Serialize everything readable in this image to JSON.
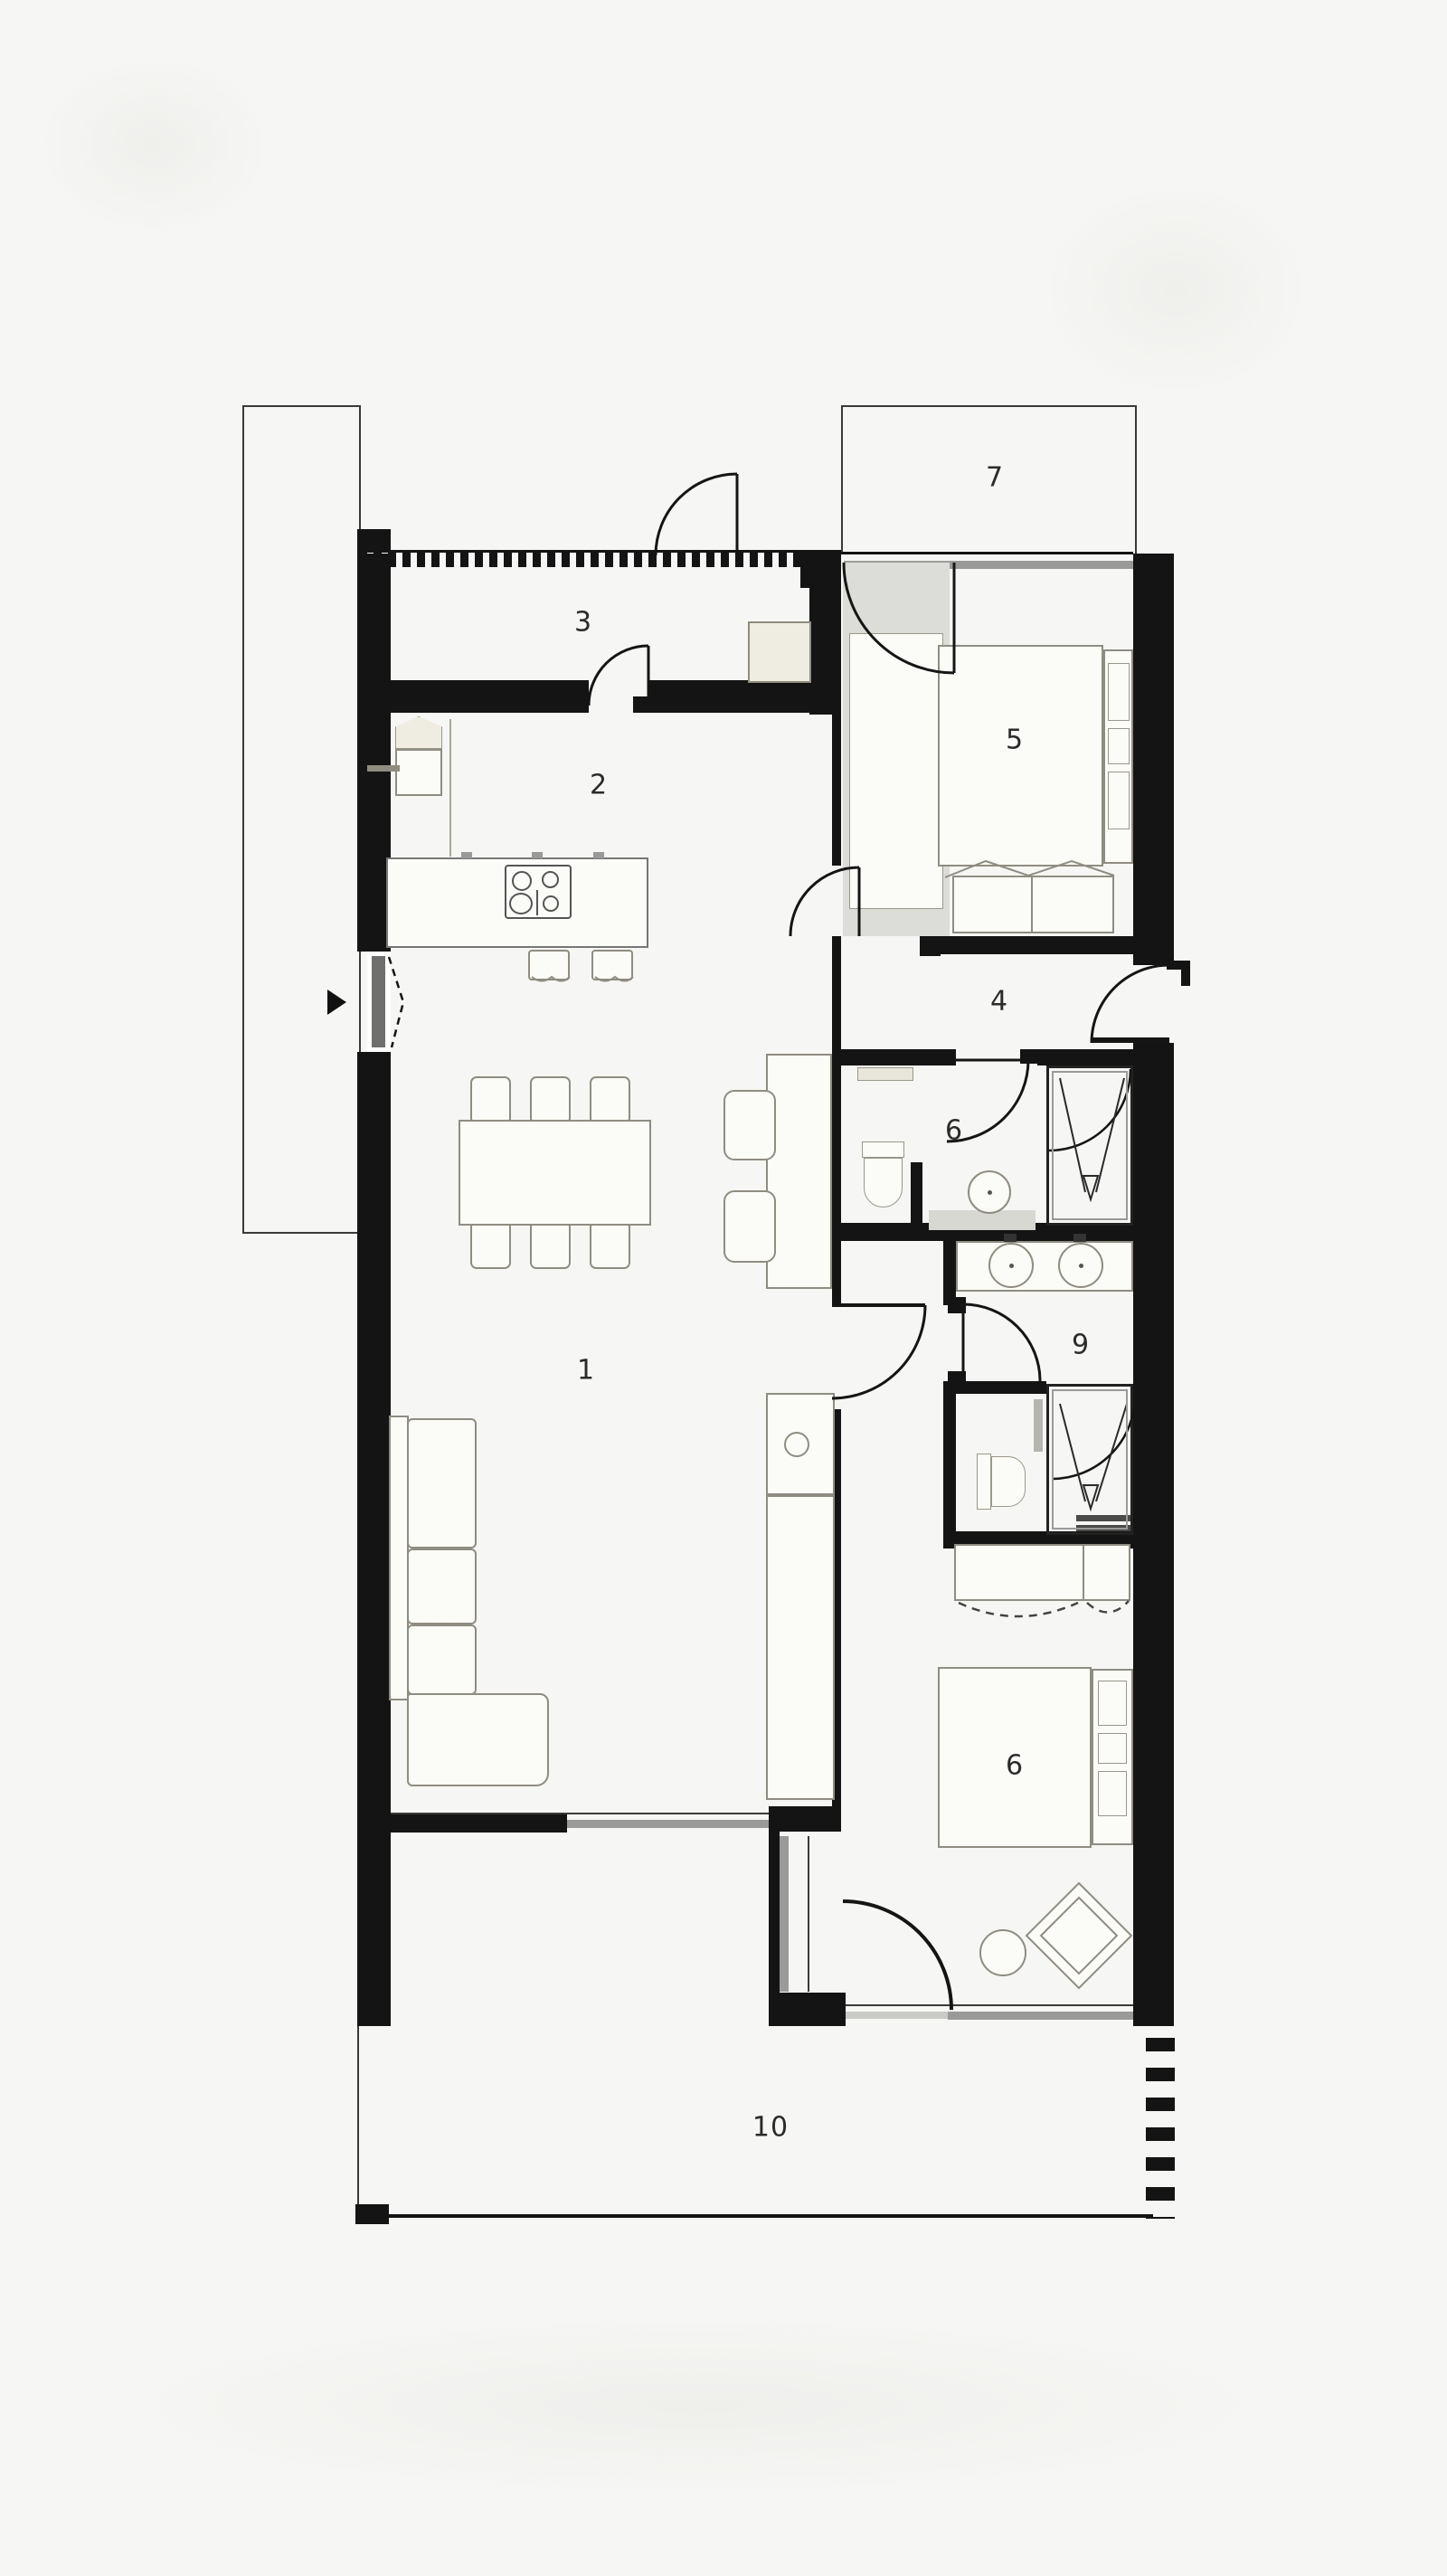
{
  "floorplan": {
    "title": "apartment-floor-plan",
    "colors": {
      "background": "#f6f6f4",
      "walls": "#141414",
      "glazing": "#9a9a98",
      "furniture_line": "#8f8d80",
      "label": "#2b2b2b"
    },
    "rooms": [
      {
        "name": "living-room",
        "label": "1"
      },
      {
        "name": "kitchen-dining",
        "label": "2"
      },
      {
        "name": "entry-hall",
        "label": "3"
      },
      {
        "name": "corridor",
        "label": "4"
      },
      {
        "name": "bedroom-upper",
        "label": "5"
      },
      {
        "name": "bathroom",
        "label": "6"
      },
      {
        "name": "balcony-upper",
        "label": "7"
      },
      {
        "name": "bedroom-lower",
        "label": "6"
      },
      {
        "name": "dressing-wc",
        "label": "9"
      },
      {
        "name": "terrace-lower",
        "label": "10"
      }
    ]
  }
}
